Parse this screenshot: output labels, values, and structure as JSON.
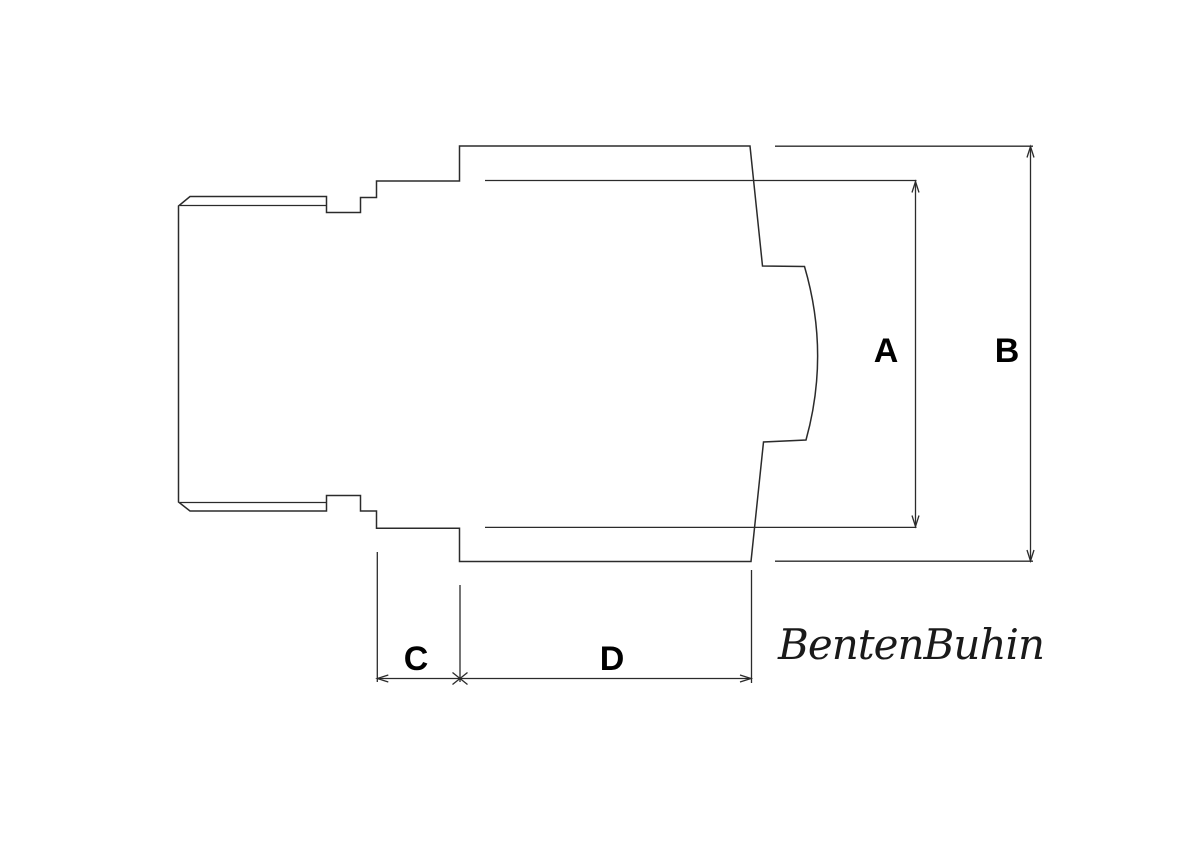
{
  "canvas": {
    "width": 1200,
    "height": 848,
    "background_color": "#ffffff",
    "line_color": "#2b2b2b"
  },
  "drawing": {
    "dimension_labels": {
      "a": "A",
      "b": "B",
      "c": "C",
      "d": "D"
    }
  },
  "signature": {
    "text": "BentenBuhin"
  }
}
